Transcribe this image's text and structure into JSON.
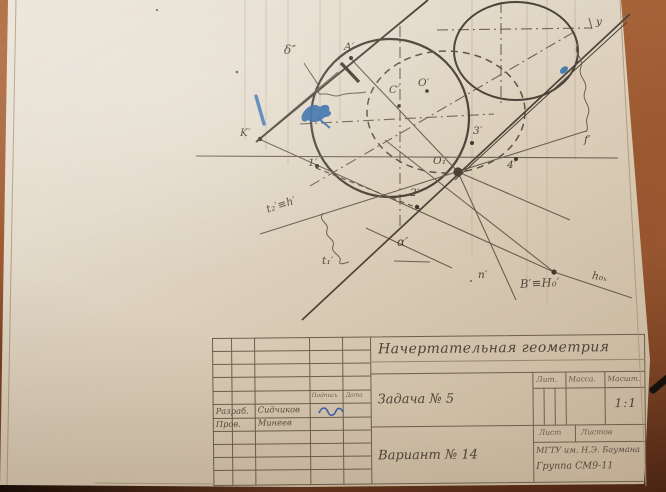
{
  "colors": {
    "pencil": "#5c5142",
    "ink_blue": "#3a74b0",
    "paper": "#ddd2c0",
    "table": "#96562f"
  },
  "drawing": {
    "labels": {
      "axis_y": "y",
      "plane_delta": "δ″",
      "point_a": "A′",
      "point_c": "C′",
      "point_o": "O′",
      "point_o1": "O₁′",
      "point_k": "K′",
      "point_b": "B′≡H₀′",
      "point_1": "1′",
      "point_2": "2′",
      "point_3": "3′",
      "point_4": "4′",
      "trace_f": "f′",
      "line_t2": "t₂′≡h′",
      "line_t1": "t₁′",
      "angle_alpha": "α′",
      "line_n": "n′",
      "axis_h0x": "h₀ₓ"
    }
  },
  "title_block": {
    "subject": "Начертательная геометрия",
    "task": "Задача № 5",
    "variant": "Вариант № 14",
    "university": "МГТУ им. Н.Э. Баумана",
    "group": "Группа СМ9-11",
    "scale_value": "1:1",
    "headers": {
      "lit": "Лит.",
      "mass": "Масса.",
      "scale": "Масшт.",
      "sheet": "Лист",
      "sheets": "Листов",
      "signature": "Подпись",
      "date": "Дата"
    },
    "staff": [
      {
        "role": "Разраб.",
        "name": "Сидчиков"
      },
      {
        "role": "Пров.",
        "name": "Минеев"
      }
    ]
  }
}
